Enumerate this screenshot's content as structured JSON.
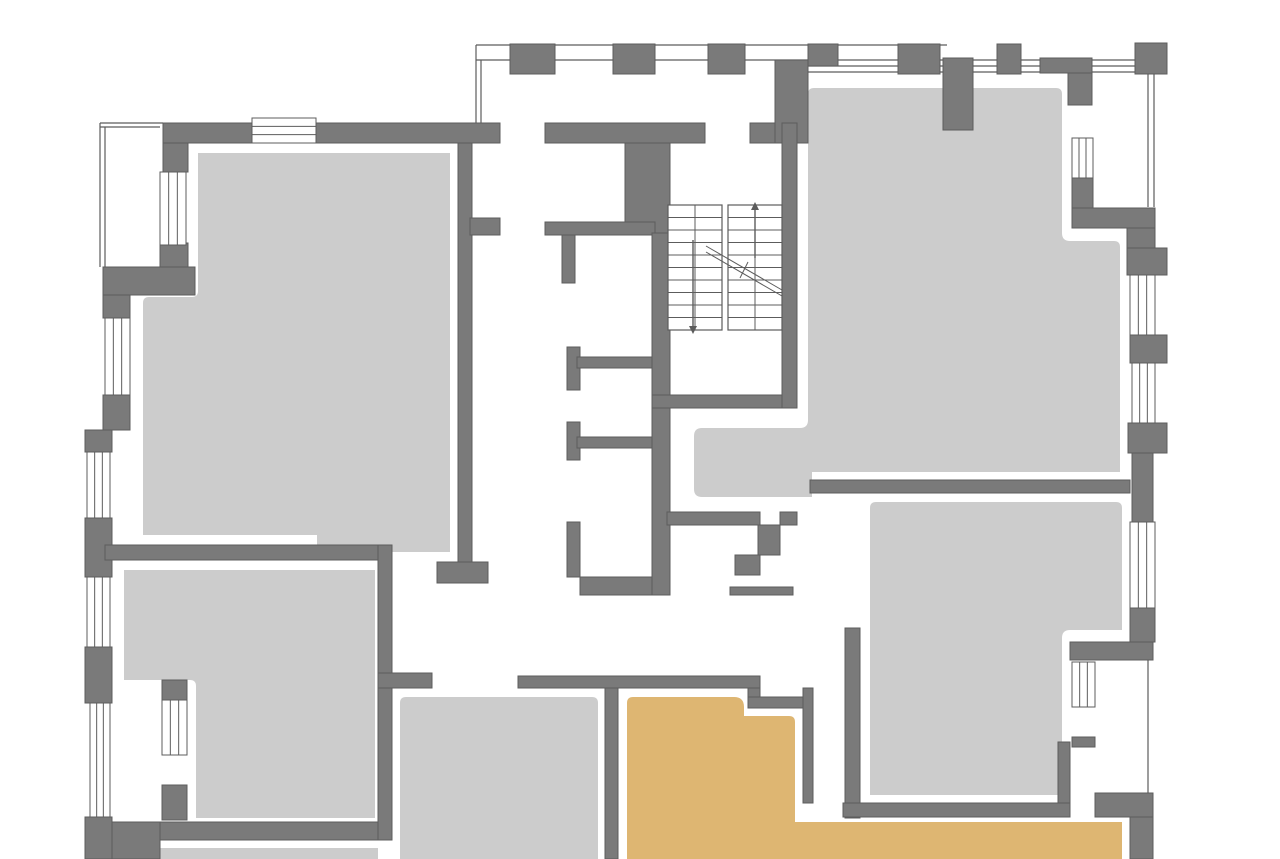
{
  "canvas": {
    "width": 1280,
    "height": 859,
    "background": "#ffffff"
  },
  "palette": {
    "wall": "#7a7a7a",
    "wall_outline": "#5c5c5c",
    "room_fill": "#cccccc",
    "highlight_fill": "#deb672",
    "thin_line": "#5c5c5c",
    "white": "#ffffff"
  },
  "rooms": [
    {
      "id": "room-top-left",
      "fill": "room_fill",
      "selected": false,
      "d": "M198,153 L450,153 L450,552 L317,552 L317,535 L143,535 L143,303 Q143,297 149,297 L192,297 Q198,297 198,291 Z"
    },
    {
      "id": "room-mid-left",
      "fill": "room_fill",
      "selected": false,
      "d": "M124,570 L375,570 L375,818 L196,818 L196,686 Q196,680 190,680 L124,680 Z"
    },
    {
      "id": "room-bottom-center",
      "fill": "room_fill",
      "selected": false,
      "d": "M400,703 Q400,697 406,697 L592,697 Q598,697 598,703 L598,859 L400,859 Z"
    },
    {
      "id": "room-top-right",
      "fill": "room_fill",
      "selected": false,
      "d": "M808,94 Q808,88 814,88 L1056,88 Q1062,88 1062,94 L1062,233 Q1062,241 1070,241 L1114,241 Q1120,241 1120,247 L1120,472 L812,472 L812,497 L702,497 Q694,497 694,489 L694,436 Q694,428 702,428 L800,428 Q808,428 808,420 Z"
    },
    {
      "id": "room-right-bottom",
      "fill": "room_fill",
      "selected": false,
      "d": "M870,508 Q870,502 876,502 L1116,502 Q1122,502 1122,508 L1122,630 L1070,630 Q1062,630 1062,638 L1062,795 L870,795 Z"
    },
    {
      "id": "room-bottom-strip",
      "fill": "room_fill",
      "selected": false,
      "d": "M160,848 L378,848 L378,859 L160,859 Z"
    },
    {
      "id": "room-highlighted-unit",
      "fill": "highlight_fill",
      "selected": true,
      "d": "M627,703 Q627,697 633,697 L734,697 Q744,697 744,707 L744,716 L789,716 Q795,716 795,722 L795,822 L1122,822 L1122,859 L627,859 Z"
    }
  ],
  "walls": [
    [
      510,
      44,
      45,
      30
    ],
    [
      613,
      44,
      42,
      30
    ],
    [
      708,
      44,
      37,
      30
    ],
    [
      808,
      44,
      30,
      22
    ],
    [
      898,
      44,
      42,
      30
    ],
    [
      997,
      44,
      24,
      30
    ],
    [
      1135,
      43,
      32,
      31
    ],
    [
      163,
      123,
      337,
      20
    ],
    [
      545,
      123,
      160,
      20
    ],
    [
      625,
      143,
      45,
      90
    ],
    [
      750,
      123,
      33,
      20
    ],
    [
      775,
      60,
      33,
      83
    ],
    [
      943,
      58,
      30,
      72
    ],
    [
      1040,
      58,
      52,
      15
    ],
    [
      1068,
      73,
      24,
      32
    ],
    [
      163,
      143,
      25,
      29
    ],
    [
      160,
      243,
      28,
      24
    ],
    [
      103,
      267,
      92,
      28
    ],
    [
      103,
      295,
      27,
      23
    ],
    [
      103,
      395,
      27,
      35
    ],
    [
      85,
      430,
      27,
      22
    ],
    [
      85,
      518,
      27,
      59
    ],
    [
      85,
      647,
      27,
      56
    ],
    [
      85,
      817,
      27,
      42
    ],
    [
      112,
      822,
      48,
      37
    ],
    [
      160,
      822,
      232,
      18
    ],
    [
      105,
      545,
      273,
      15
    ],
    [
      378,
      545,
      14,
      295
    ],
    [
      458,
      143,
      14,
      419
    ],
    [
      437,
      562,
      51,
      21
    ],
    [
      470,
      218,
      30,
      17
    ],
    [
      545,
      222,
      110,
      13
    ],
    [
      562,
      235,
      13,
      48
    ],
    [
      567,
      347,
      13,
      43
    ],
    [
      577,
      357,
      78,
      11
    ],
    [
      567,
      422,
      13,
      38
    ],
    [
      577,
      437,
      75,
      11
    ],
    [
      567,
      522,
      13,
      55
    ],
    [
      580,
      577,
      87,
      18
    ],
    [
      652,
      233,
      18,
      362
    ],
    [
      652,
      395,
      145,
      13
    ],
    [
      782,
      123,
      15,
      285
    ],
    [
      667,
      512,
      93,
      13
    ],
    [
      780,
      512,
      17,
      13
    ],
    [
      758,
      525,
      22,
      30
    ],
    [
      735,
      555,
      25,
      20
    ],
    [
      730,
      587,
      63,
      8
    ],
    [
      378,
      673,
      54,
      15
    ],
    [
      518,
      676,
      242,
      12
    ],
    [
      605,
      688,
      13,
      171
    ],
    [
      748,
      688,
      12,
      20
    ],
    [
      748,
      697,
      65,
      11
    ],
    [
      803,
      688,
      10,
      115
    ],
    [
      845,
      628,
      15,
      190
    ],
    [
      843,
      803,
      227,
      14
    ],
    [
      1058,
      742,
      12,
      61
    ],
    [
      810,
      480,
      320,
      13
    ],
    [
      1072,
      178,
      21,
      30
    ],
    [
      1072,
      208,
      83,
      20
    ],
    [
      1127,
      228,
      28,
      20
    ],
    [
      1127,
      248,
      40,
      27
    ],
    [
      1130,
      335,
      37,
      28
    ],
    [
      1128,
      423,
      39,
      30
    ],
    [
      1132,
      453,
      21,
      69
    ],
    [
      1130,
      608,
      25,
      34
    ],
    [
      1070,
      642,
      83,
      18
    ],
    [
      1072,
      737,
      23,
      10
    ],
    [
      1095,
      793,
      58,
      24
    ],
    [
      1130,
      817,
      23,
      42
    ],
    [
      162,
      680,
      25,
      20
    ],
    [
      162,
      785,
      25,
      35
    ]
  ],
  "windows": [
    [
      252,
      118,
      64,
      25,
      "h"
    ],
    [
      160,
      172,
      26,
      73,
      "v"
    ],
    [
      105,
      318,
      25,
      77,
      "v"
    ],
    [
      87,
      452,
      23,
      66,
      "v"
    ],
    [
      87,
      577,
      23,
      70,
      "v"
    ],
    [
      90,
      703,
      20,
      114,
      "v"
    ],
    [
      162,
      700,
      25,
      55,
      "v"
    ],
    [
      1072,
      138,
      21,
      40,
      "v"
    ],
    [
      1130,
      275,
      25,
      60,
      "v"
    ],
    [
      1132,
      363,
      23,
      60,
      "v"
    ],
    [
      1130,
      522,
      25,
      86,
      "v"
    ],
    [
      1072,
      662,
      23,
      45,
      "v"
    ]
  ],
  "thin_lines": [
    [
      476,
      45,
      947,
      45
    ],
    [
      476,
      60,
      1148,
      60
    ],
    [
      808,
      66,
      1148,
      66
    ],
    [
      808,
      72,
      1148,
      72
    ],
    [
      476,
      45,
      476,
      123
    ],
    [
      481,
      60,
      481,
      123
    ],
    [
      1148,
      74,
      1148,
      207
    ],
    [
      1154,
      74,
      1154,
      207
    ],
    [
      1148,
      612,
      1148,
      793
    ],
    [
      100,
      123,
      100,
      267
    ],
    [
      105,
      127,
      105,
      267
    ],
    [
      100,
      123,
      163,
      123
    ],
    [
      100,
      127,
      160,
      127
    ]
  ],
  "stairs": {
    "flights": [
      {
        "x": 668,
        "y": 205,
        "w": 54,
        "h": 125,
        "steps": 10
      },
      {
        "x": 728,
        "y": 205,
        "w": 54,
        "h": 125,
        "steps": 10
      }
    ],
    "arrows": [
      {
        "x": 755,
        "y_tail": 258,
        "y_head": 210,
        "dir": "up"
      },
      {
        "x": 693,
        "y_tail": 240,
        "y_head": 326,
        "dir": "down"
      }
    ],
    "break_line": {
      "x1": 706,
      "y1": 246,
      "x2": 782,
      "y2": 290,
      "offset": 6
    }
  }
}
